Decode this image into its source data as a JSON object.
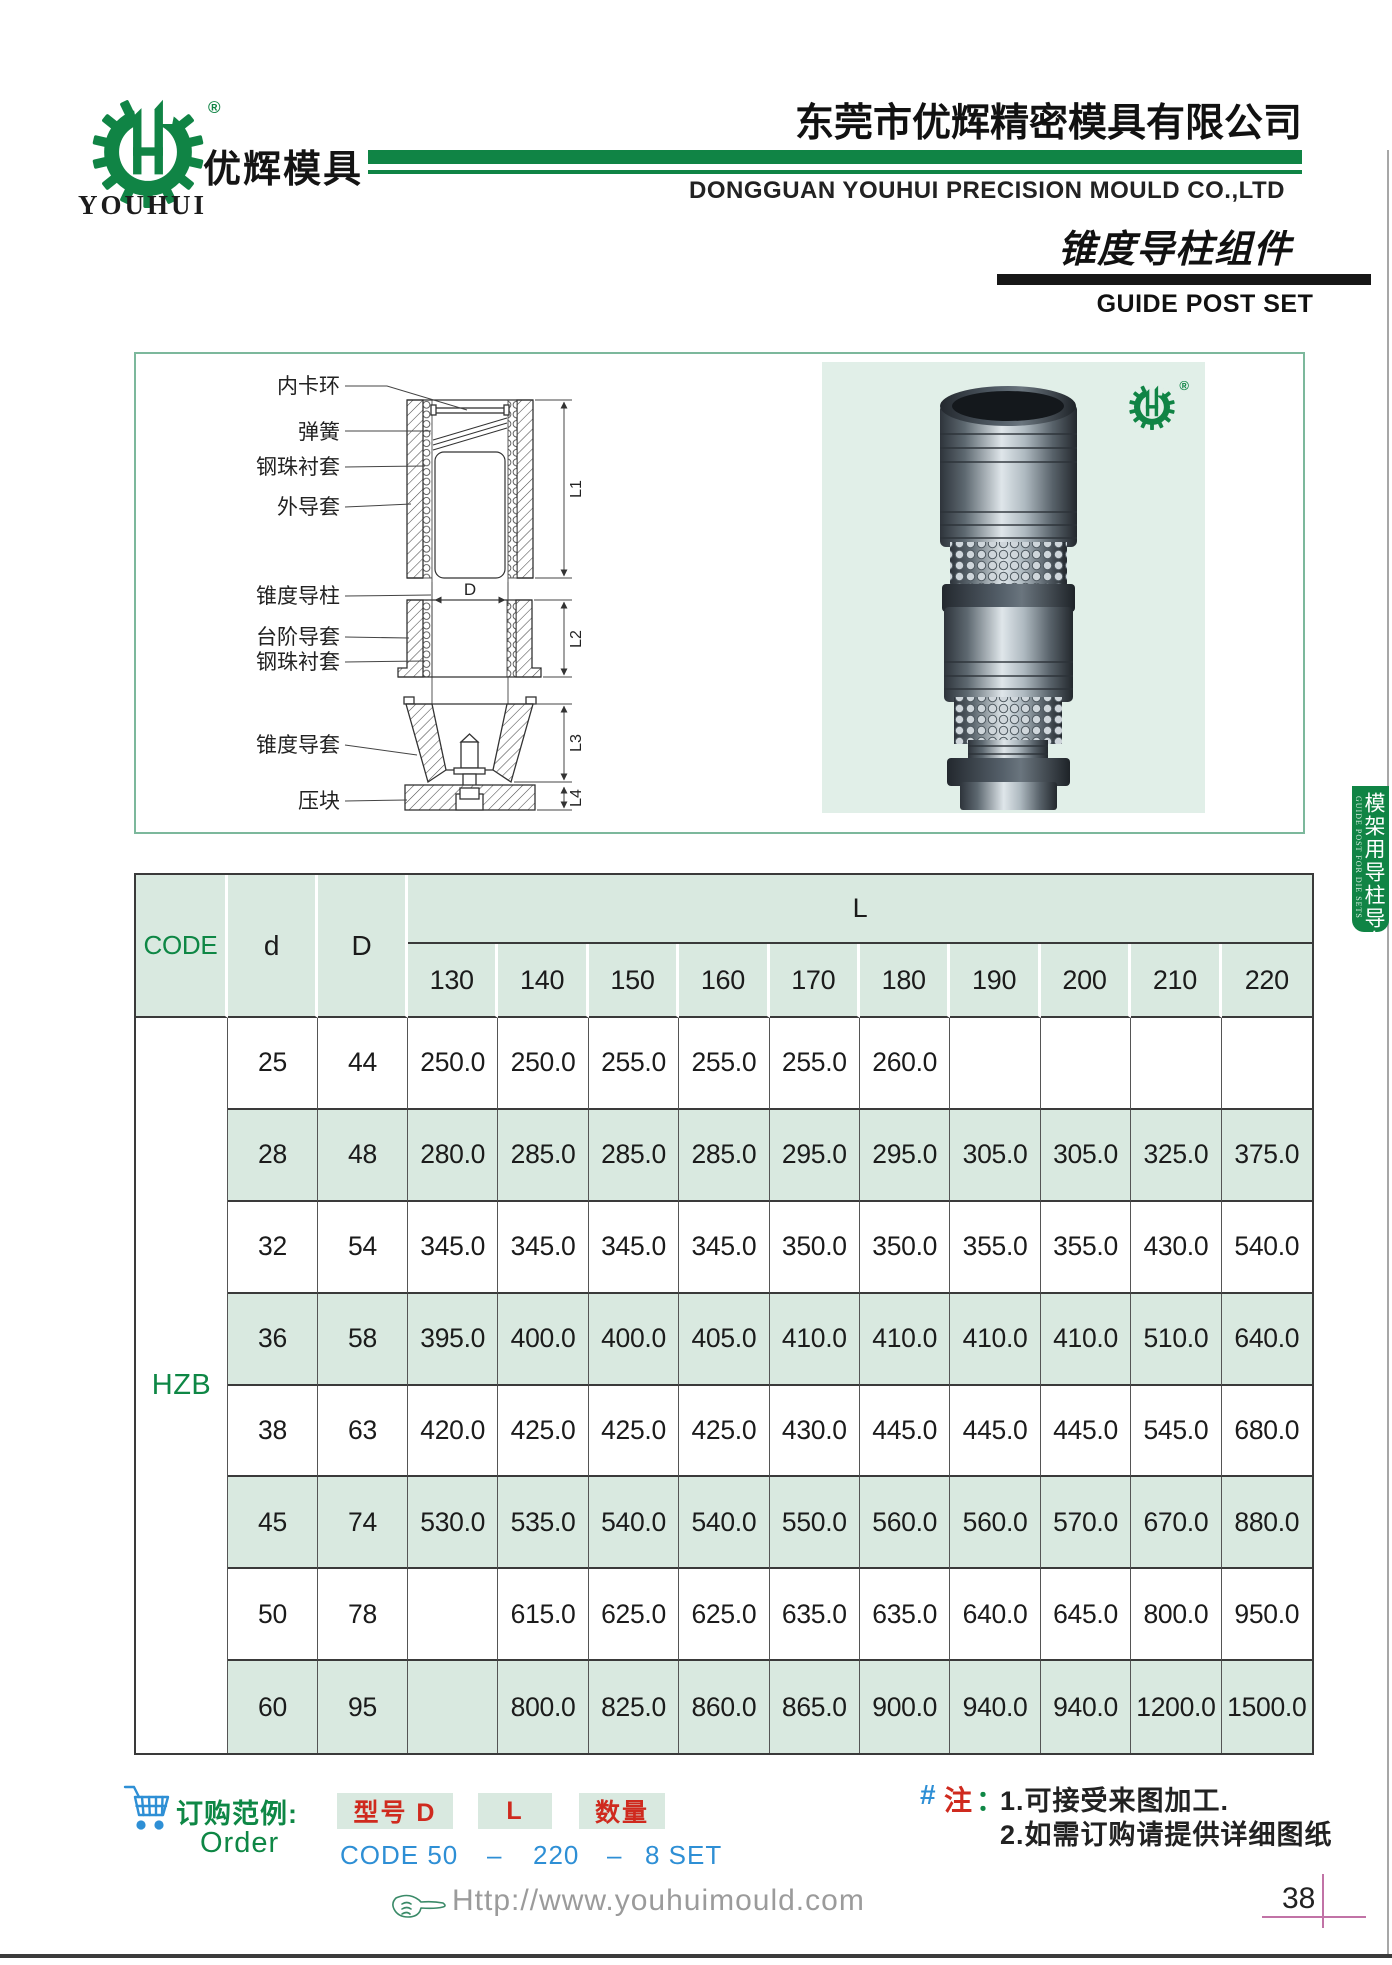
{
  "brand": {
    "logo_text_cn": "优辉模具",
    "logo_text_en": "YOUHUI",
    "registered_mark": "®",
    "green": "#108445"
  },
  "header": {
    "company_cn": "东莞市优辉精密模具有限公司",
    "company_en": "DONGGUAN YOUHUI PRECISION MOULD CO.,LTD",
    "product_cn": "锥度导柱组件",
    "product_en": "GUIDE POST SET"
  },
  "side_tab": {
    "cn": "模架用导柱导套",
    "en": "GUIDE POST FOR DIE SETS"
  },
  "diagram": {
    "labels": [
      "内卡环",
      "弹簧",
      "钢珠衬套",
      "外导套",
      "锥度导柱",
      "台阶导套",
      "钢珠衬套",
      "锥度导套",
      "压块"
    ],
    "dim_d": "D",
    "dim_l1": "L1",
    "dim_l2": "L2",
    "dim_l3": "L3",
    "dim_l4": "L4"
  },
  "table": {
    "headers": {
      "code": "CODE",
      "d": "d",
      "D": "D",
      "L": "L"
    },
    "lengths": [
      "130",
      "140",
      "150",
      "160",
      "170",
      "180",
      "190",
      "200",
      "210",
      "220"
    ],
    "code_value": "HZB",
    "rows": [
      {
        "d": "25",
        "D": "44",
        "values": [
          "250.0",
          "250.0",
          "255.0",
          "255.0",
          "255.0",
          "260.0",
          "",
          "",
          "",
          ""
        ]
      },
      {
        "d": "28",
        "D": "48",
        "values": [
          "280.0",
          "285.0",
          "285.0",
          "285.0",
          "295.0",
          "295.0",
          "305.0",
          "305.0",
          "325.0",
          "375.0"
        ]
      },
      {
        "d": "32",
        "D": "54",
        "values": [
          "345.0",
          "345.0",
          "345.0",
          "345.0",
          "350.0",
          "350.0",
          "355.0",
          "355.0",
          "430.0",
          "540.0"
        ]
      },
      {
        "d": "36",
        "D": "58",
        "values": [
          "395.0",
          "400.0",
          "400.0",
          "405.0",
          "410.0",
          "410.0",
          "410.0",
          "410.0",
          "510.0",
          "640.0"
        ]
      },
      {
        "d": "38",
        "D": "63",
        "values": [
          "420.0",
          "425.0",
          "425.0",
          "425.0",
          "430.0",
          "445.0",
          "445.0",
          "445.0",
          "545.0",
          "680.0"
        ]
      },
      {
        "d": "45",
        "D": "74",
        "values": [
          "530.0",
          "535.0",
          "540.0",
          "540.0",
          "550.0",
          "560.0",
          "560.0",
          "570.0",
          "670.0",
          "880.0"
        ]
      },
      {
        "d": "50",
        "D": "78",
        "values": [
          "",
          "615.0",
          "625.0",
          "625.0",
          "635.0",
          "635.0",
          "640.0",
          "645.0",
          "800.0",
          "950.0"
        ]
      },
      {
        "d": "60",
        "D": "95",
        "values": [
          "",
          "800.0",
          "825.0",
          "860.0",
          "865.0",
          "900.0",
          "940.0",
          "940.0",
          "1200.0",
          "1500.0"
        ]
      }
    ]
  },
  "order": {
    "label_cn": "订购范例:",
    "label_en": "Order",
    "box_model": "型号  D",
    "box_l": "L",
    "box_qty": "数量",
    "example_code": "CODE 50",
    "dash1": "–",
    "example_l": "220",
    "dash2": "–",
    "example_qty": "8 SET"
  },
  "notes": {
    "hash": "#",
    "label": "注",
    "colon": "：",
    "line1": "1.可接受来图加工.",
    "line2": "2.如需订购请提供详细图纸"
  },
  "footer": {
    "url": "Http://www.youhuimould.com",
    "page_number": "38"
  }
}
